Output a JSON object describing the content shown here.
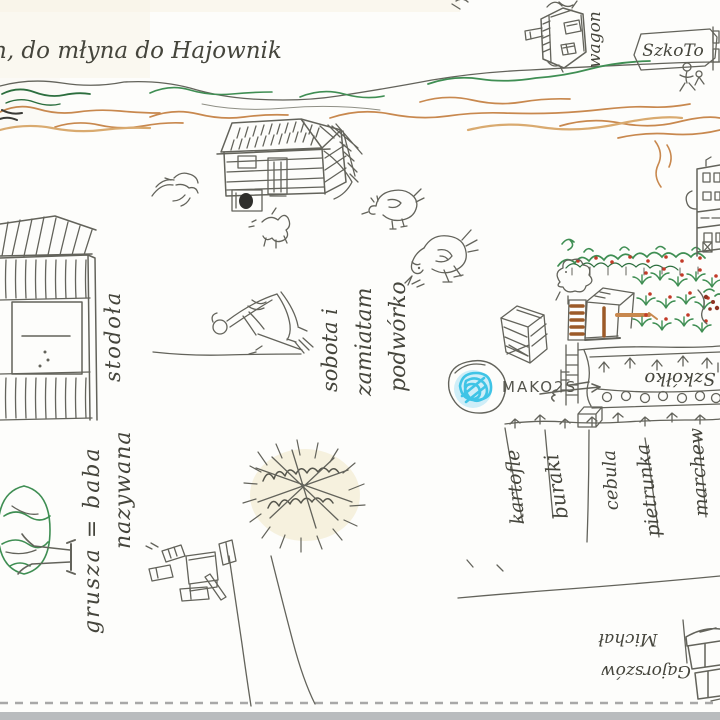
{
  "captions": {
    "title": "n, do młyna do Hajownik",
    "wagon": "wagon",
    "school_sign": "SzkoTo",
    "barn": "stodoła",
    "sweeping": {
      "line1": "sobota i",
      "line2": "zamiatam",
      "line3": "podwórko"
    },
    "mirror_text": "MAKO2S",
    "nursery": "Szkółko",
    "pear_tree": {
      "line1": "grusza = baba",
      "line2": "nazywana"
    },
    "farmer": {
      "line1": "Gajorszów",
      "line2": "Michał"
    }
  },
  "garden_rows": [
    "kartofle",
    "buraki",
    "cebula",
    "pietrunka",
    "marchew"
  ],
  "colors": {
    "pencil": "#63635b",
    "green": "#3f8e53",
    "dark_green": "#2c6e3e",
    "orange": "#c8884e",
    "tan": "#d9aa6f",
    "brown": "#9c5a28",
    "red": "#c33a28",
    "blue": "#3fc4e6",
    "paper": "#fdfdfb",
    "scan_strip": "#b9bcbe"
  }
}
